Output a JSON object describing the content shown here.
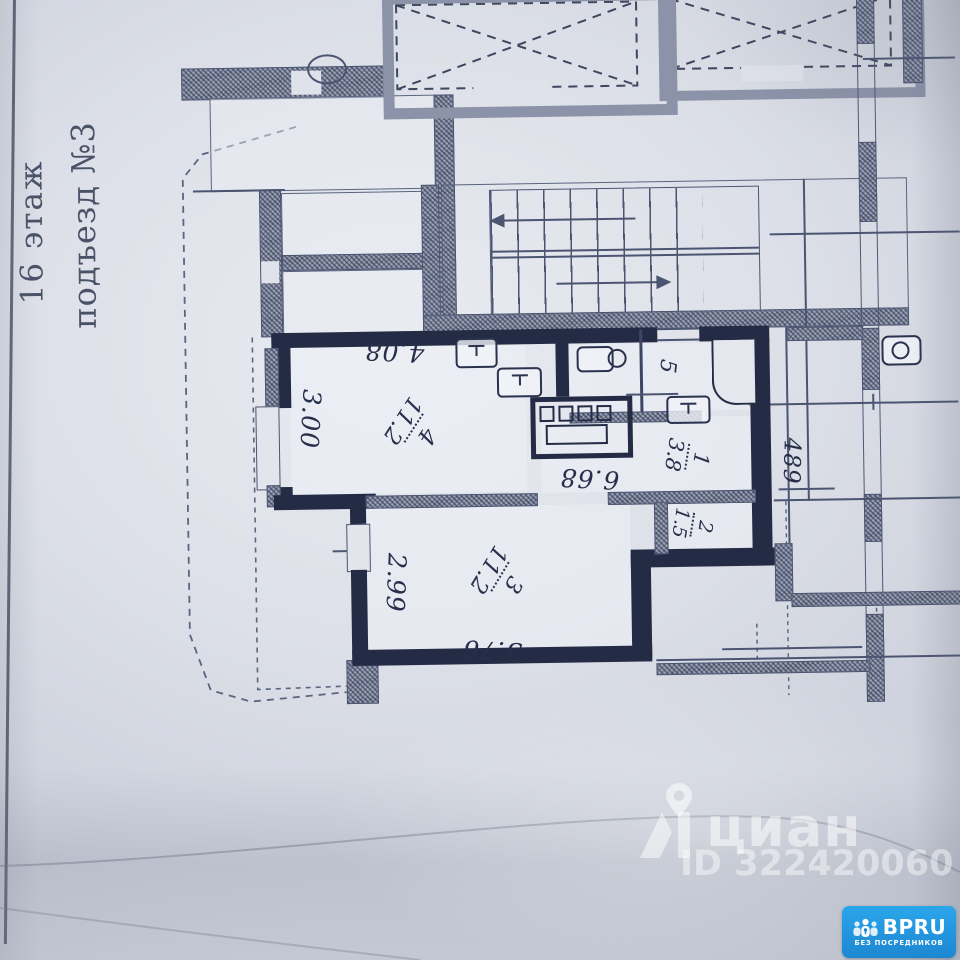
{
  "side_text": {
    "floor": "16 этаж",
    "entrance": "подъезд №3"
  },
  "plan": {
    "rooms": [
      {
        "number": "4",
        "area": "11.2"
      },
      {
        "number": "3",
        "area": "11.2"
      },
      {
        "number": "1",
        "area": "3.8"
      },
      {
        "number": "2",
        "area": "1.5"
      },
      {
        "number": "5",
        "area": ""
      }
    ],
    "dimensions": {
      "room4_width": "4.08",
      "room4_depth": "3.00",
      "inner_span": "6.68",
      "room3_depth": "2.99",
      "room3_width": "3.76",
      "corridor_width": "489"
    }
  },
  "watermark": {
    "brand": "циан",
    "listing_id": "ID 322420060"
  },
  "badge": {
    "brand": "BPRU",
    "tagline": "БЕЗ ПОСРЕДНИКОВ"
  },
  "colors": {
    "wall": "#242c45",
    "badge_blue": "#1d87d2",
    "paper": "#dde0e8"
  }
}
